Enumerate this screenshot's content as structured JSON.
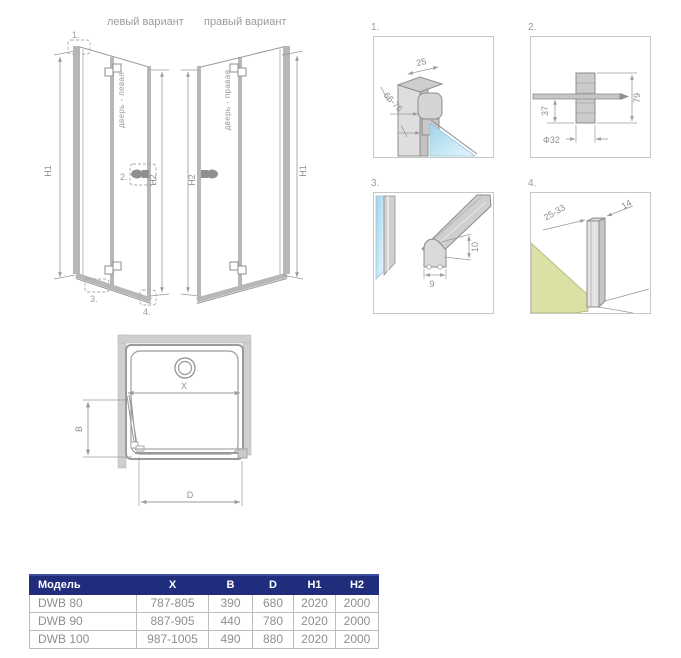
{
  "colors": {
    "line_gray": "#9a9a9a",
    "profile_gray": "#b7b7b7",
    "glass_blue": "#9ed3eb",
    "tray_green": "#dbe1a4",
    "table_header_bg": "#202d7c",
    "table_border": "#bdbdbd",
    "table_text": "#8f8f8f",
    "label_text": "#9b9b9b"
  },
  "header": {
    "left_variant_label": "левый вариант",
    "right_variant_label": "правый вариант"
  },
  "left_diagram": {
    "door_label": "дверь - левая",
    "dim_outer": "H1",
    "dim_inner": "H2",
    "callout_1": "1.",
    "callout_2": "2.",
    "callout_3": "3.",
    "callout_4": "4."
  },
  "right_diagram": {
    "door_label": "дверь - правая",
    "dim_inner": "H2",
    "dim_outer": "H1"
  },
  "details": [
    {
      "number": "1.",
      "dim_a": "25",
      "dim_b": "66-76"
    },
    {
      "number": "2.",
      "dim_a": "37",
      "dim_b": "79",
      "dim_c": "Ф32"
    },
    {
      "number": "3.",
      "dim_a": "9",
      "dim_b": "10"
    },
    {
      "number": "4.",
      "dim_a": "25-33",
      "dim_b": "14"
    }
  ],
  "top_view": {
    "dim_x": "X",
    "dim_b": "B",
    "dim_d": "D"
  },
  "table": {
    "headers": [
      "Модель",
      "X",
      "B",
      "D",
      "H1",
      "H2"
    ],
    "rows": [
      [
        "DWB 80",
        "787-805",
        "390",
        "680",
        "2020",
        "2000"
      ],
      [
        "DWB 90",
        "887-905",
        "440",
        "780",
        "2020",
        "2000"
      ],
      [
        "DWB 100",
        "987-1005",
        "490",
        "880",
        "2020",
        "2000"
      ]
    ]
  }
}
